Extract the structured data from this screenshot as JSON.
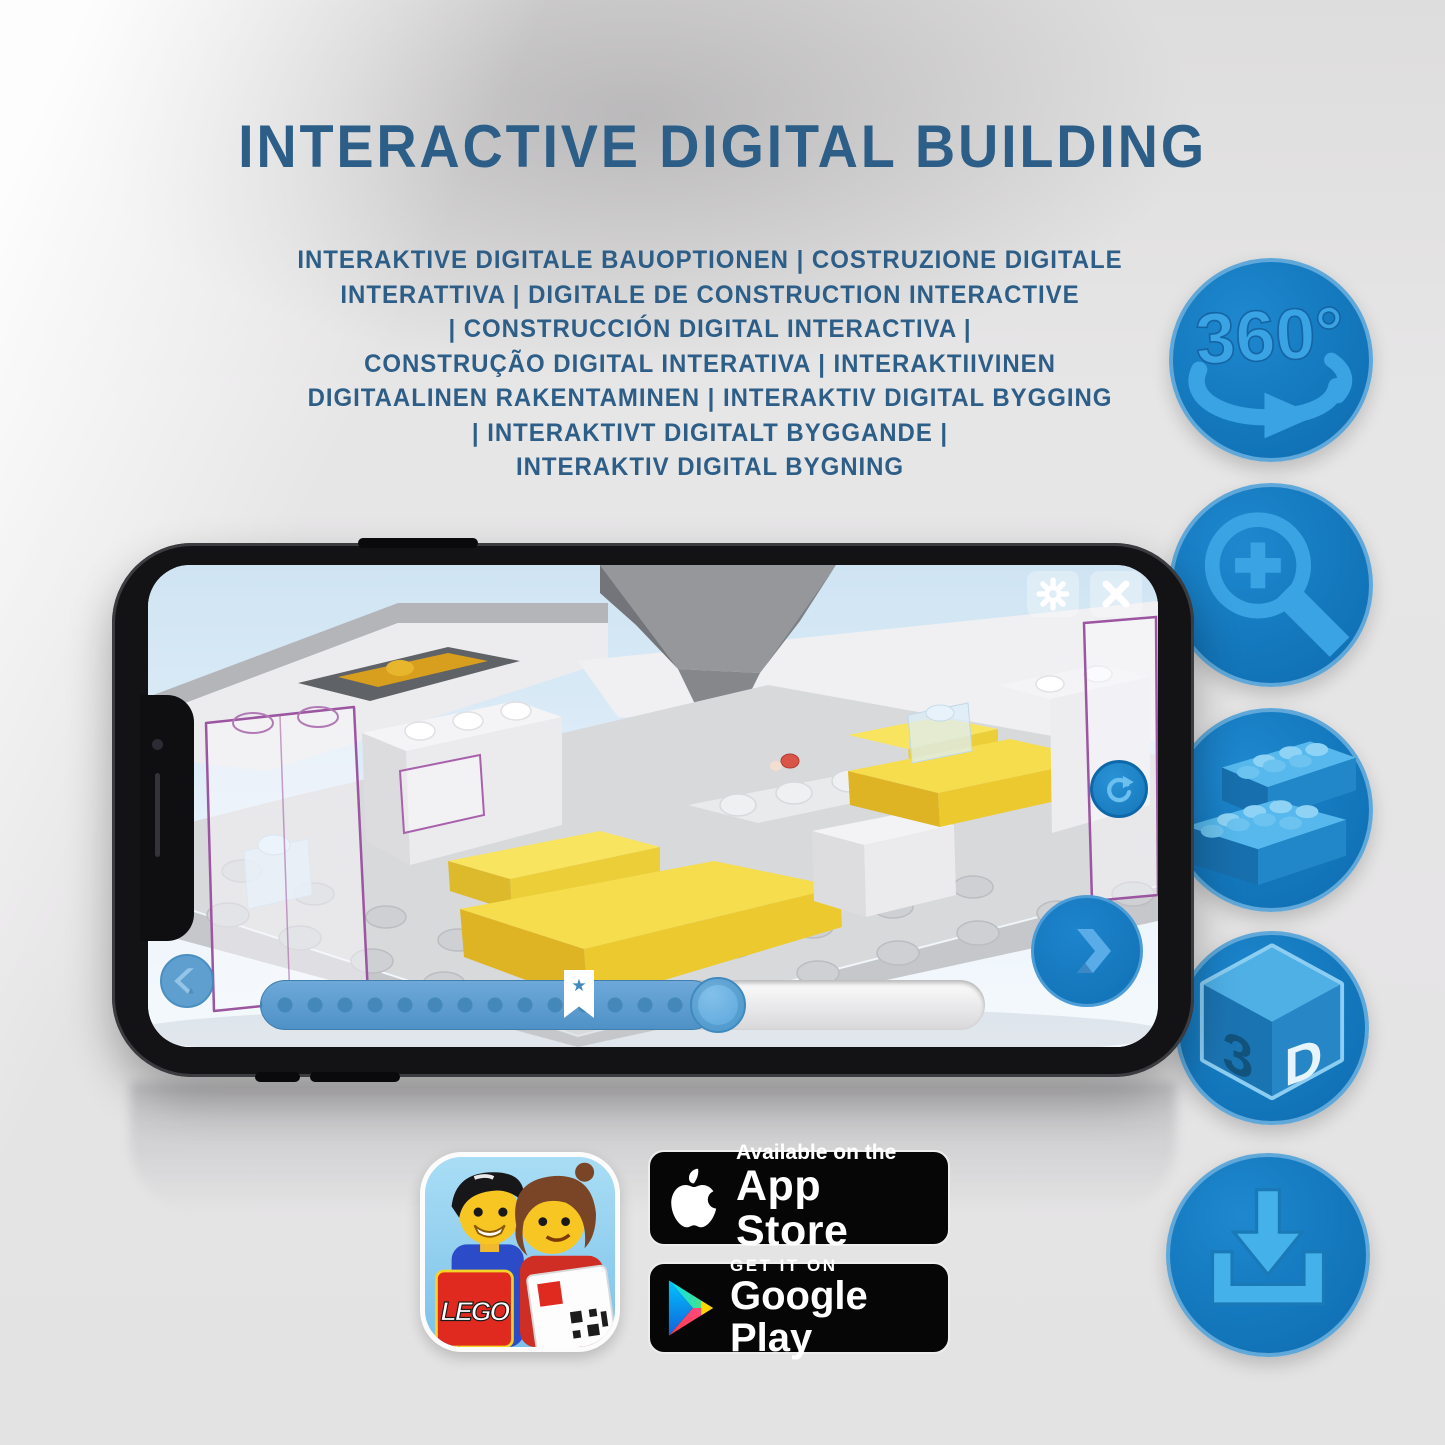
{
  "header": {
    "title": "INTERACTIVE DIGITAL BUILDING",
    "subtitle_lines": [
      "INTERAKTIVE DIGITALE BAUOPTIONEN | COSTRUZIONE DIGITALE",
      "INTERATTIVA | DIGITALE DE CONSTRUCTION INTERACTIVE",
      "| CONSTRUCCIÓN DIGITAL INTERACTIVA |",
      "CONSTRUÇÃO DIGITAL INTERATIVA | INTERAKTIIVINEN",
      "DIGITAALINEN RAKENTAMINEN | INTERAKTIV DIGITAL BYGGING",
      "| INTERAKTIVT DIGITALT BYGGANDE |",
      "INTERAKTIV DIGITAL BYGNING"
    ]
  },
  "feature_icons": [
    {
      "id": "360-rotation",
      "label": "360°"
    },
    {
      "id": "zoom-in"
    },
    {
      "id": "brick-building"
    },
    {
      "id": "3d-view",
      "face_letters": {
        "left": "3",
        "right": "D"
      }
    },
    {
      "id": "download"
    }
  ],
  "phone": {
    "screen_buttons": [
      "settings-gear",
      "close",
      "rotate-reset",
      "previous-step",
      "next-step"
    ],
    "slider": {
      "progress_percent": 63,
      "bookmark_percent": 44,
      "bookmark_glyph": "★"
    }
  },
  "store": {
    "app_icon": {
      "logo_text": "LEGO"
    },
    "app_store_badge": {
      "line1": "Available on the",
      "line2": "App Store"
    },
    "google_play_badge": {
      "line1": "GET IT ON",
      "line2": "Google Play"
    }
  },
  "colors": {
    "title_blue": "#2d5e87",
    "accent_blue": "#1478bd",
    "icon_glyph": "#3aa3e3",
    "circle_rim": "#5fa8d9",
    "slider_fill": "#5b9dd1",
    "slider_dot": "#4488ba",
    "lego_yellow": "#f2d43c",
    "ghost_purple": "#9c55a0",
    "badge_black": "#060606"
  }
}
